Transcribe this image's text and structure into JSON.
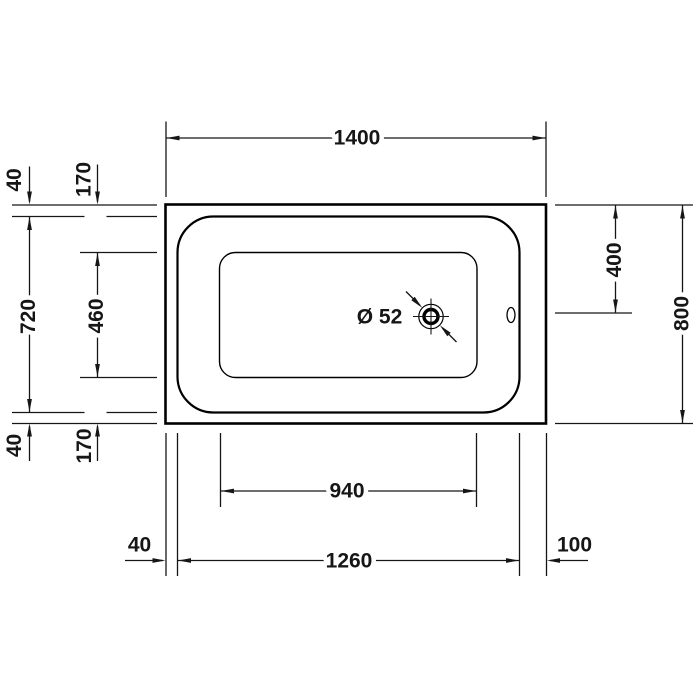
{
  "drawing": {
    "subject": "bathtub-top-view-technical-drawing",
    "background": "#ffffff",
    "line_color": "#161616",
    "outline_color": "#000000"
  },
  "dimensions": {
    "overall_width": "1400",
    "overall_depth": "800",
    "rim_offset_top": "40",
    "basin_offset_top": "170",
    "rim_inner_depth": "720",
    "basin_depth": "460",
    "rim_offset_bottom": "40",
    "basin_offset_bottom": "170",
    "drain_center_from_top": "400",
    "basin_width": "940",
    "rim_inner_width": "1260",
    "rim_offset_left": "40",
    "rim_offset_right": "100",
    "drain_diameter": "Ø 52"
  }
}
